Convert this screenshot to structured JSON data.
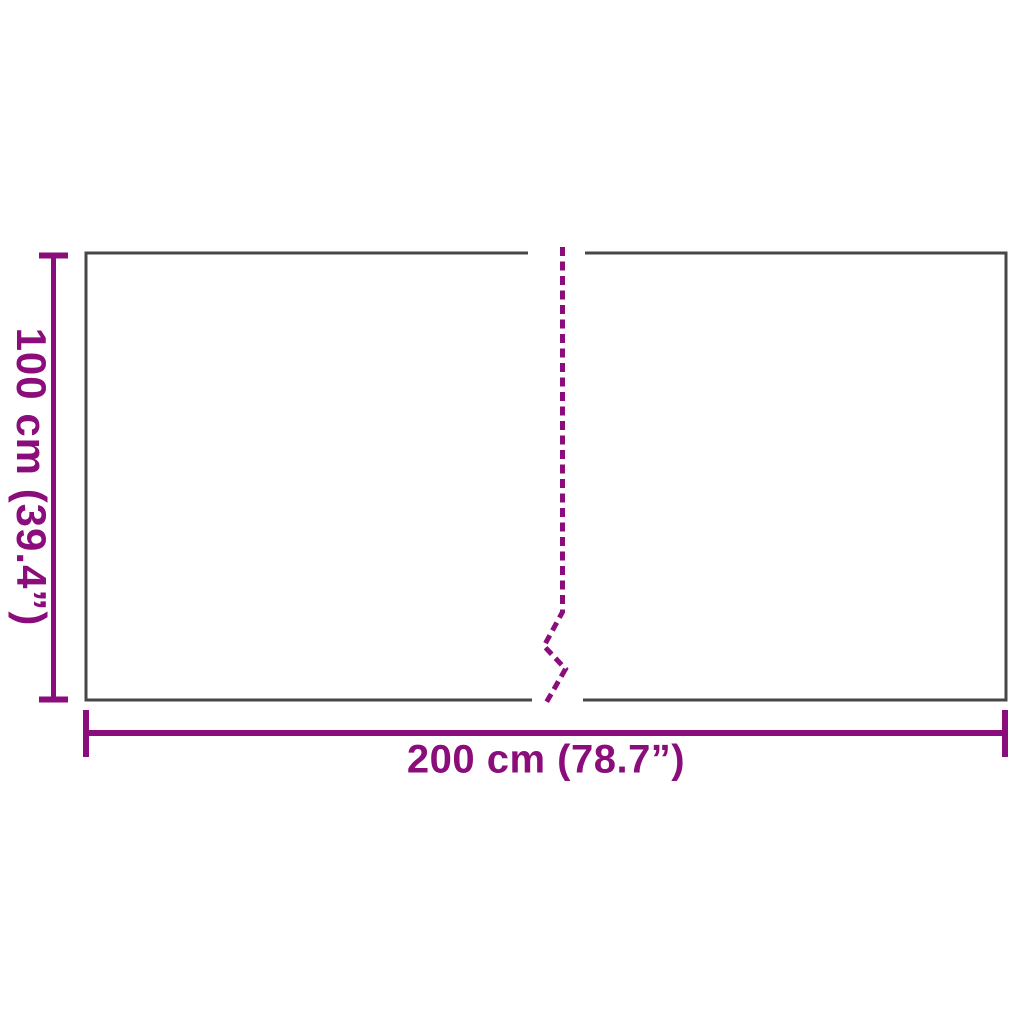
{
  "labels": {
    "height": "100 cm (39.4”)",
    "width": "200 cm (78.7”)"
  },
  "dimensions": {
    "width_cm": 200,
    "height_cm": 100,
    "width_inches": 78.7,
    "height_inches": 39.4
  },
  "colors": {
    "accent": "#8A0D7B",
    "outline": "#474747",
    "background": "#FFFFFF"
  },
  "figure": {
    "shape": "rectangle-panel",
    "seam": "center-vertical-dashed-with-zigzag"
  }
}
